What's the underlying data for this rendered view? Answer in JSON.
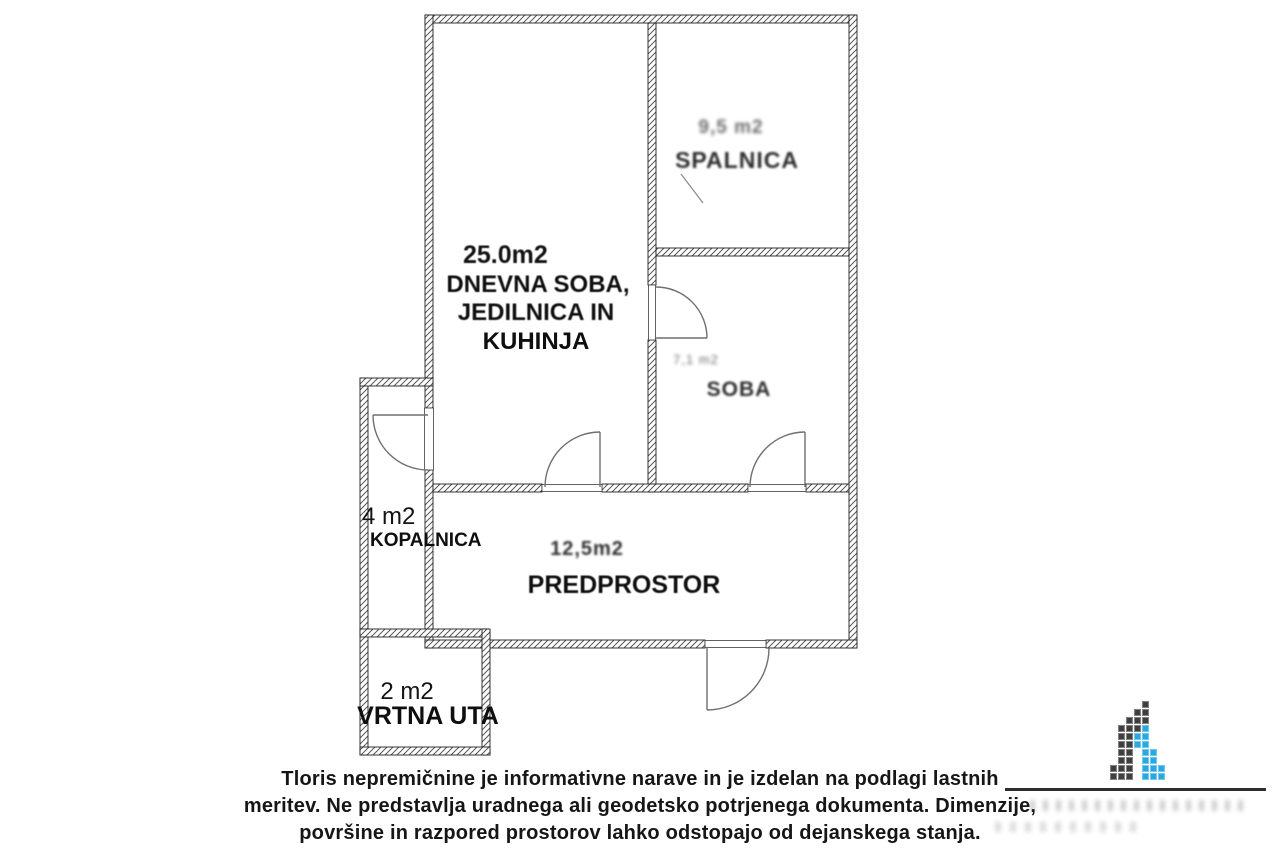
{
  "page": {
    "background": "#ffffff"
  },
  "plan": {
    "rooms": {
      "living": {
        "area": "25.0m2",
        "name_line1": "DNEVNA SOBA,",
        "name_line2": "JEDILNICA IN",
        "name_line3": "KUHINJA"
      },
      "bedroom": {
        "area": "9,5 m2",
        "name": "SPALNICA"
      },
      "small_room": {
        "area": "7,1 m2",
        "name": "SOBA"
      },
      "hall": {
        "area": "12,5m2",
        "name": "PREDPROSTOR"
      },
      "bathroom": {
        "area": "4 m2",
        "name": "KOPALNICA"
      },
      "garden_shed": {
        "area": "2 m2",
        "name": "VRTNA UTA"
      }
    }
  },
  "disclaimer": {
    "line1": "Tloris nepremičnine je informativne narave in je izdelan na podlagi lastnih",
    "line2": "meritev. Ne predstavlja uradnega ali geodetsko potrjenega dokumenta. Dimenzije,",
    "line3": "površine in razpored prostorov lahko odstopajo od dejanskega stanja."
  },
  "logo": {
    "icon": "pixel-building-logo",
    "colors": {
      "dark": "#3f3f3f",
      "blue": "#29a9e1"
    },
    "grid": [
      "....D..",
      "...DD..",
      "..DDD..",
      ".DDDB..",
      ".DDBB..",
      ".DDBB..",
      ".DD.BB.",
      ".DD.BB.",
      "DDD.BBB",
      "DDD.BBB"
    ]
  }
}
